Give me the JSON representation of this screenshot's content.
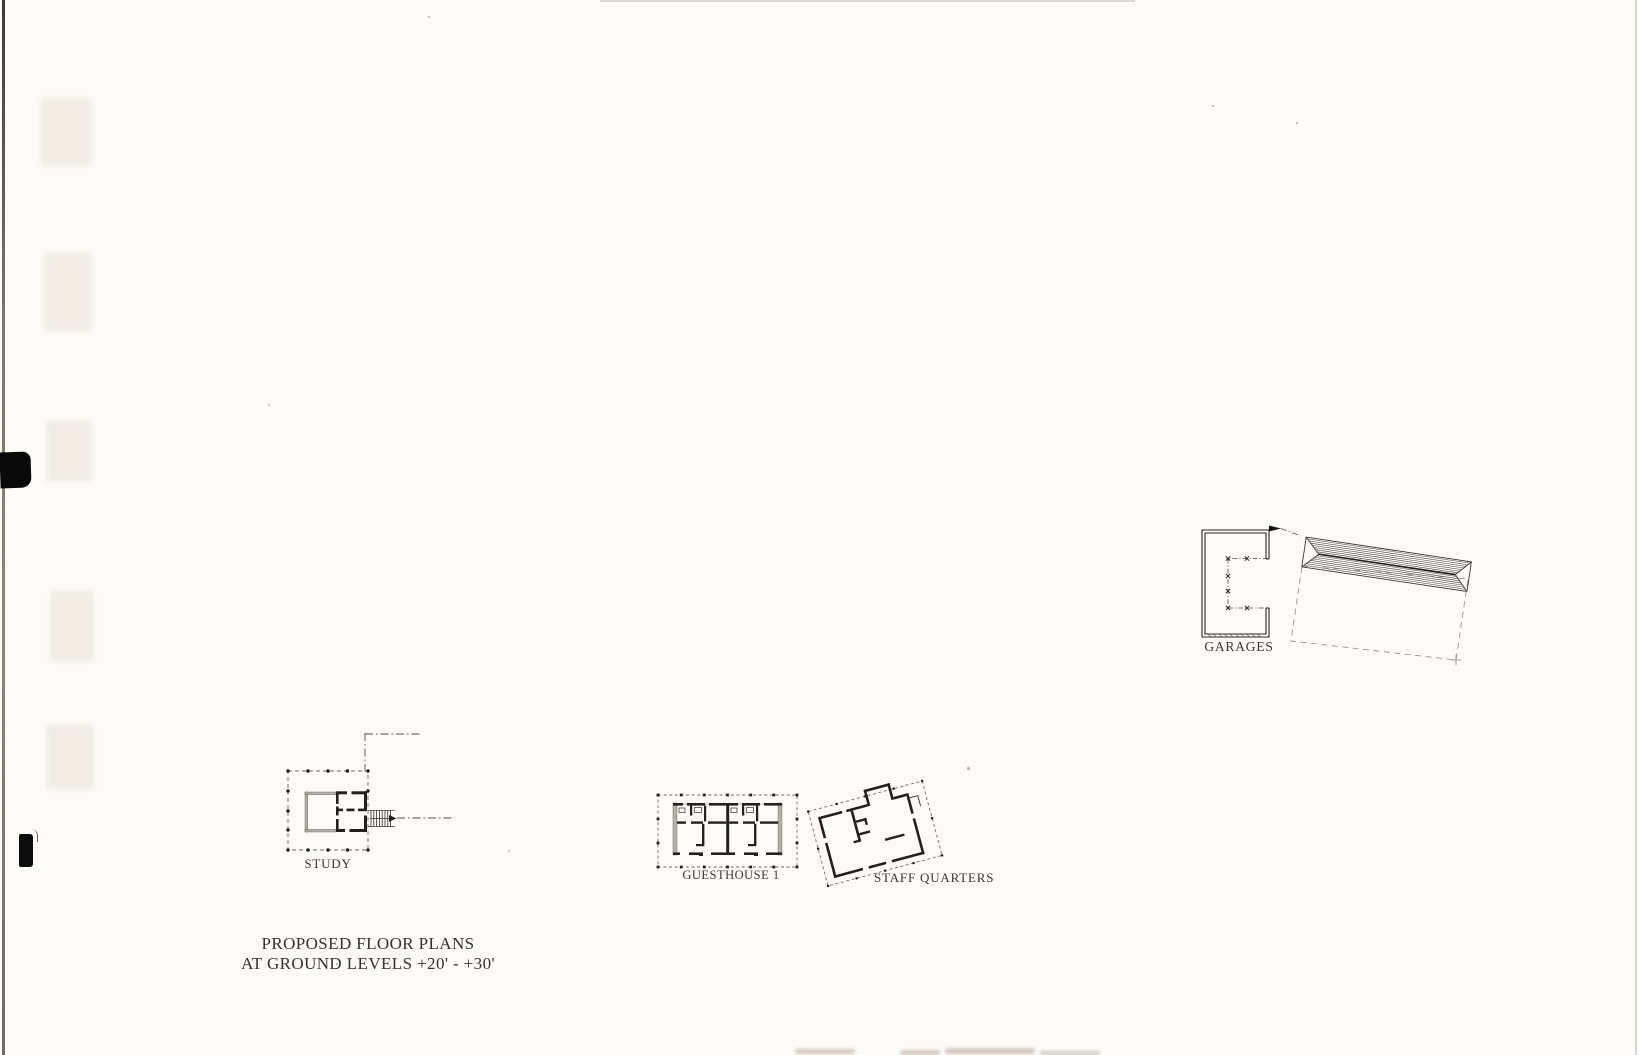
{
  "page": {
    "background": "#fcfbf7",
    "ink": "#35322d"
  },
  "title": {
    "line1": "PROPOSED FLOOR PLANS",
    "line2": "AT GROUND LEVELS +20' - +30'"
  },
  "plans": {
    "study": {
      "label": "STUDY"
    },
    "guesthouse1": {
      "label": "GUESTHOUSE 1"
    },
    "staff_quarters": {
      "label": "STAFF QUARTERS"
    },
    "garages": {
      "label": "GARAGES"
    }
  }
}
